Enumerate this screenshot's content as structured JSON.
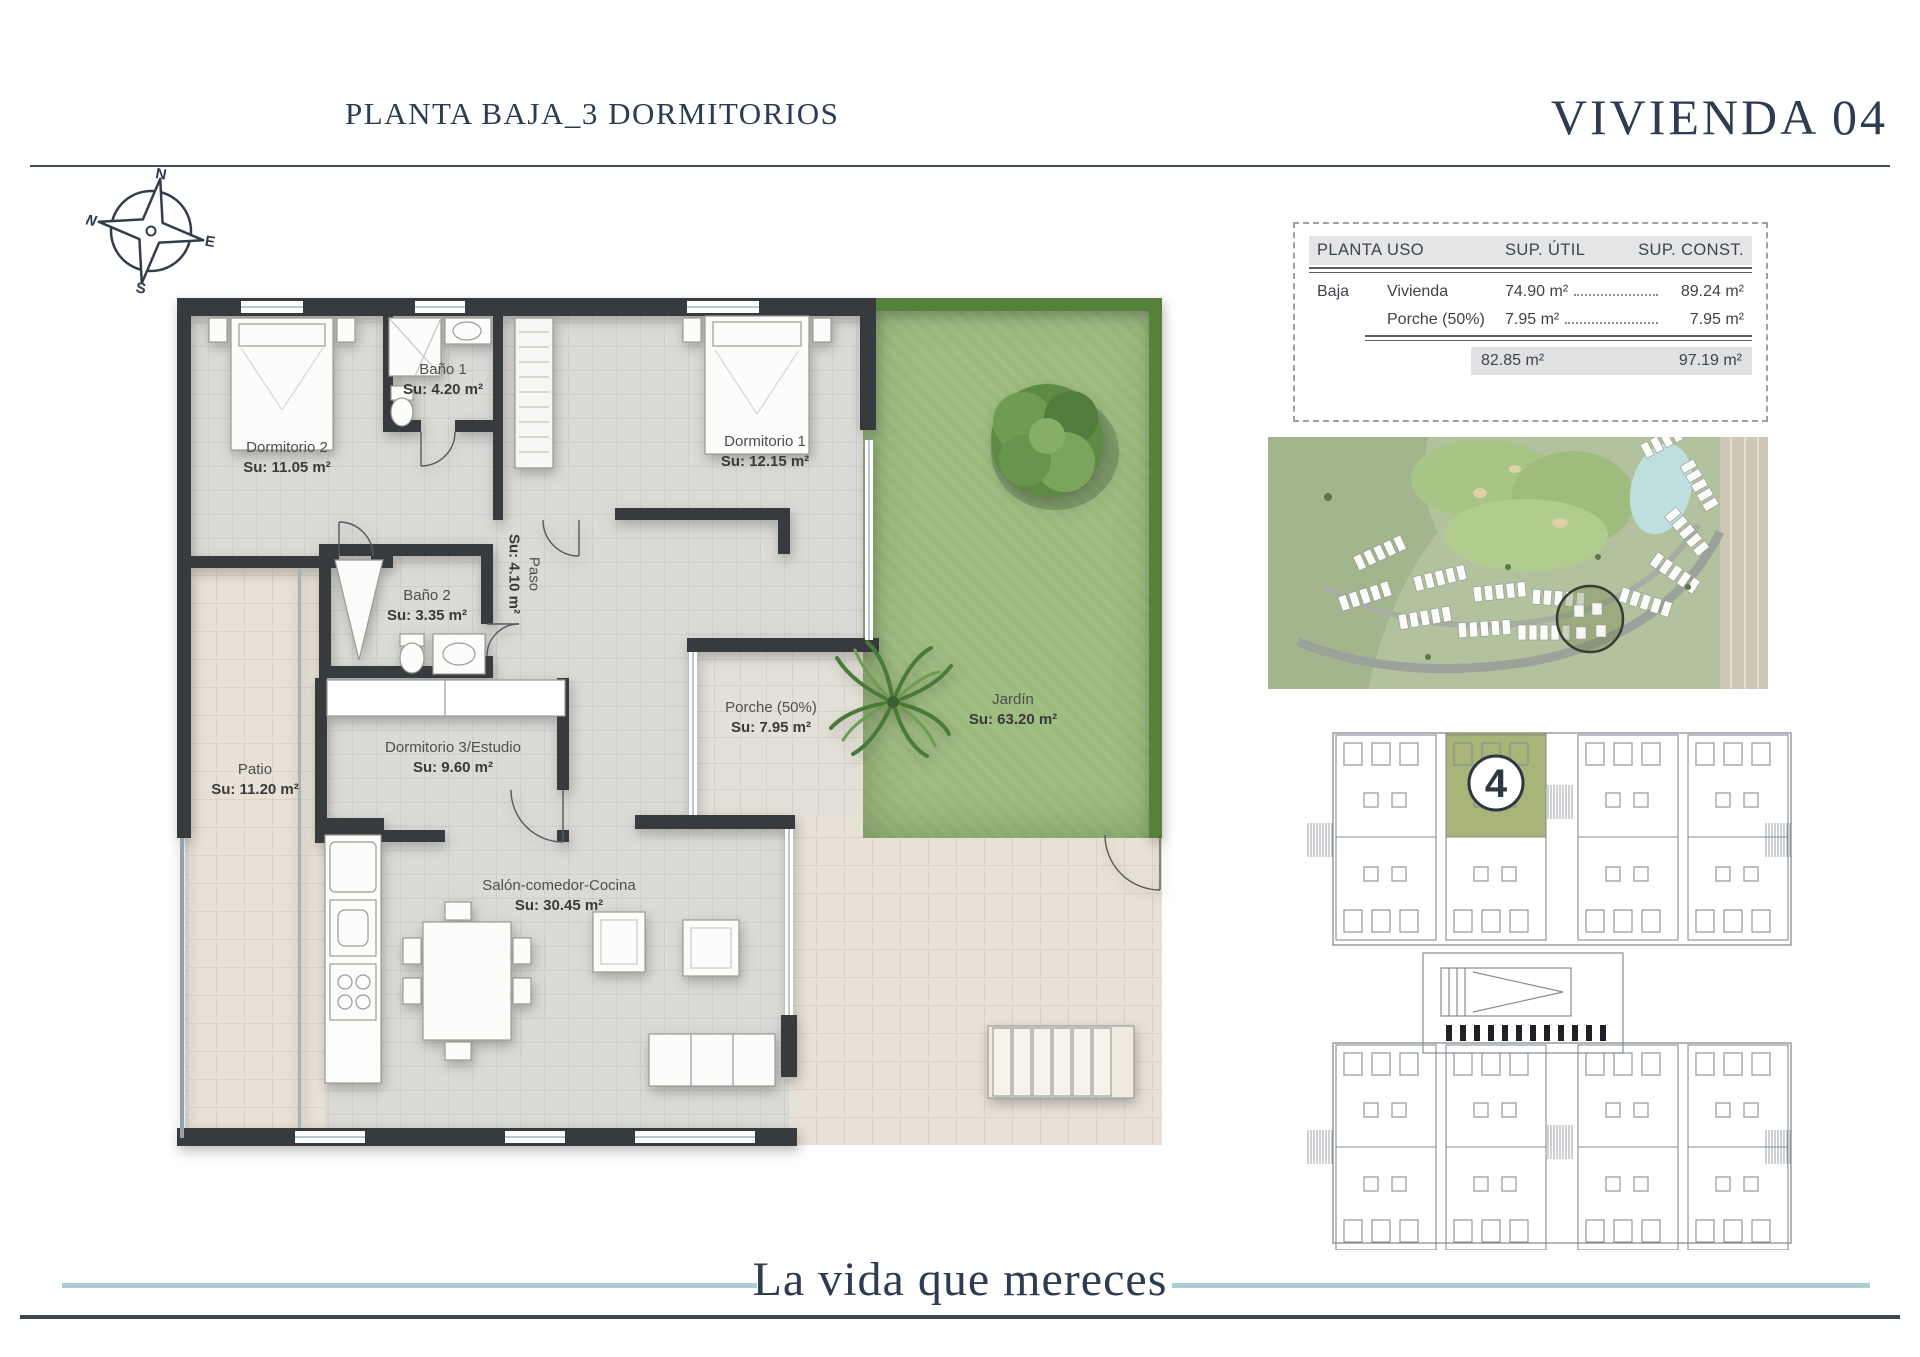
{
  "header": {
    "title": "PLANTA BAJA_3 DORMITORIOS",
    "unit": "VIVIENDA 04"
  },
  "compass": {
    "n": "N",
    "e": "E",
    "s": "S",
    "w": "W"
  },
  "area_table": {
    "headers": {
      "planta": "PLANTA",
      "uso": "USO",
      "sup_util": "SUP. ÚTIL",
      "sup_const": "SUP. CONST."
    },
    "rows": [
      {
        "planta": "Baja",
        "uso": "Vivienda",
        "sup_util": "74.90 m²",
        "sup_const": "89.24 m²"
      },
      {
        "planta": "",
        "uso": "Porche (50%)",
        "sup_util": "7.95 m²",
        "sup_const": "7.95 m²"
      }
    ],
    "totals": {
      "sup_util": "82.85 m²",
      "sup_const": "97.19 m²"
    }
  },
  "rooms": {
    "dormitorio2": {
      "name": "Dormitorio 2",
      "area": "Su: 11.05 m²"
    },
    "bano1": {
      "name": "Baño 1",
      "area": "Su: 4.20 m²"
    },
    "dormitorio1": {
      "name": "Dormitorio 1",
      "area": "Su: 12.15 m²"
    },
    "paso": {
      "name": "Paso",
      "area": "Su: 4.10 m²"
    },
    "bano2": {
      "name": "Baño 2",
      "area": "Su: 3.35 m²"
    },
    "patio": {
      "name": "Patio",
      "area": "Su: 11.20 m²"
    },
    "dormitorio3": {
      "name": "Dormitorio 3/Estudio",
      "area": "Su: 9.60 m²"
    },
    "porche": {
      "name": "Porche (50%)",
      "area": "Su: 7.95 m²"
    },
    "jardin": {
      "name": "Jardín",
      "area": "Su: 63.20 m²"
    },
    "salon": {
      "name": "Salón-comedor-Cocina",
      "area": "Su: 30.45 m²"
    }
  },
  "key_plan": {
    "unit_number": "4"
  },
  "footer": {
    "tagline": "La vida que mereces"
  },
  "colors": {
    "accent_navy": "#2d3c50",
    "tagline_line": "#accdd3",
    "highlight_olive": "#a8b478",
    "garden_green": "#9cba7e",
    "wall_dark": "#383b3e"
  }
}
